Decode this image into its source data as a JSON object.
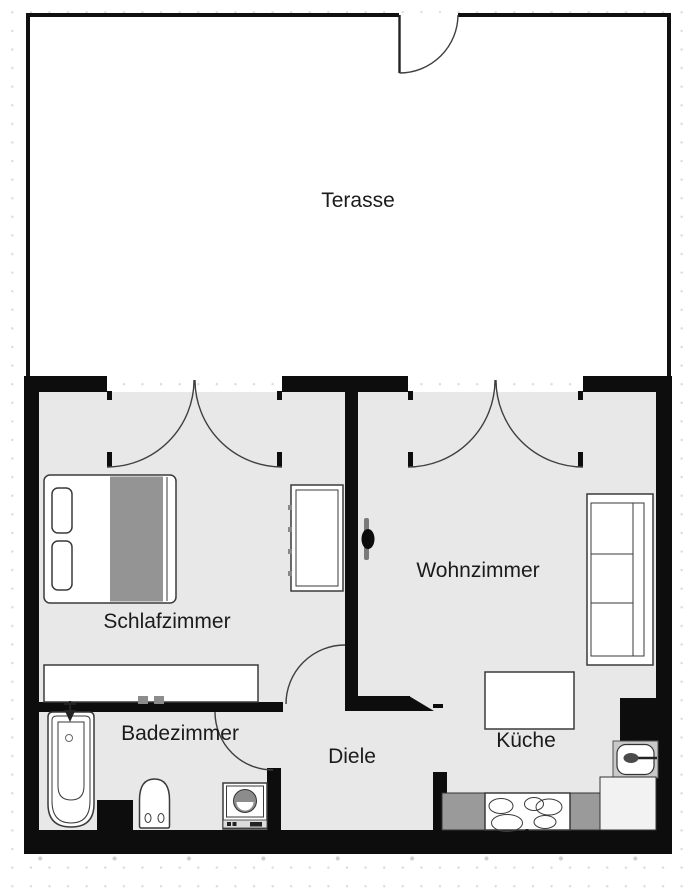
{
  "floorplan": {
    "rooms": [
      {
        "id": "terasse",
        "label": "Terasse"
      },
      {
        "id": "schlafzimmer",
        "label": "Schlafzimmer"
      },
      {
        "id": "wohnzimmer",
        "label": "Wohnzimmer"
      },
      {
        "id": "badezimmer",
        "label": "Badezimmer"
      },
      {
        "id": "diele",
        "label": "Diele"
      },
      {
        "id": "kueche",
        "label": "Küche"
      }
    ],
    "furniture": [
      "double-bed",
      "wardrobe",
      "sideboard",
      "wall-tv",
      "sofa",
      "dining-table",
      "kitchen-sink",
      "stove",
      "kitchen-counters",
      "bathtub",
      "toilet",
      "washing-machine"
    ],
    "doors": [
      "terrace-door",
      "schlafzimmer-double-door",
      "wohnzimmer-double-door",
      "schlafzimmer-hall-door",
      "badezimmer-door"
    ],
    "colors": {
      "wall": "#0d0d0d",
      "floor": "#e8e8e8",
      "terrace_floor": "#ffffff",
      "outline": "#3a3a3a",
      "furn_gray": "#949494",
      "label_text": "#1b1b1b"
    }
  }
}
